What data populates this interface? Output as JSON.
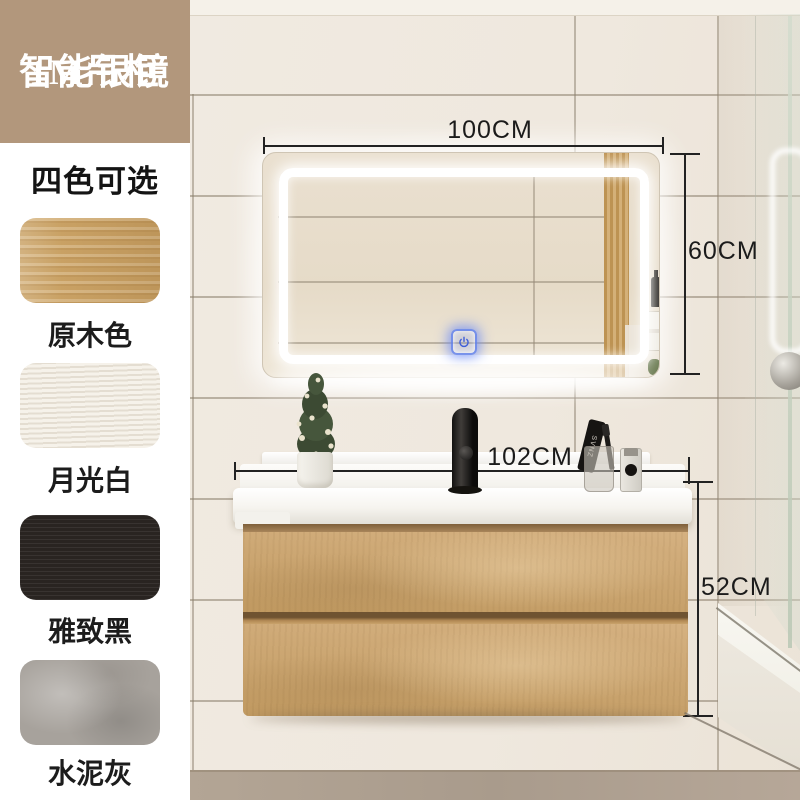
{
  "badge": {
    "line1": "1M吊柜",
    "line2": "智能银镜"
  },
  "sidebar": {
    "heading": "四色可选",
    "colors": [
      {
        "label": "原木色",
        "hex": "#c9a164"
      },
      {
        "label": "月光白",
        "hex": "#ece6da"
      },
      {
        "label": "雅致黑",
        "hex": "#292421"
      },
      {
        "label": "水泥灰",
        "hex": "#a7a29c"
      }
    ]
  },
  "dimensions": {
    "mirror_width": "100CM",
    "mirror_height": "60CM",
    "vanity_width": "102CM",
    "vanity_height": "52CM"
  },
  "counter_items": {
    "toothpaste_label": "SVNZ"
  },
  "icons": {
    "power_button": "power-symbol"
  },
  "palette": {
    "badge_bg": "#b2977c",
    "wall": "#efe9e0",
    "cabinet_wood": "#c9a46c",
    "counter_white": "#f8f6f2",
    "led_accent": "#5b7de0",
    "dimension_line": "#222222"
  }
}
